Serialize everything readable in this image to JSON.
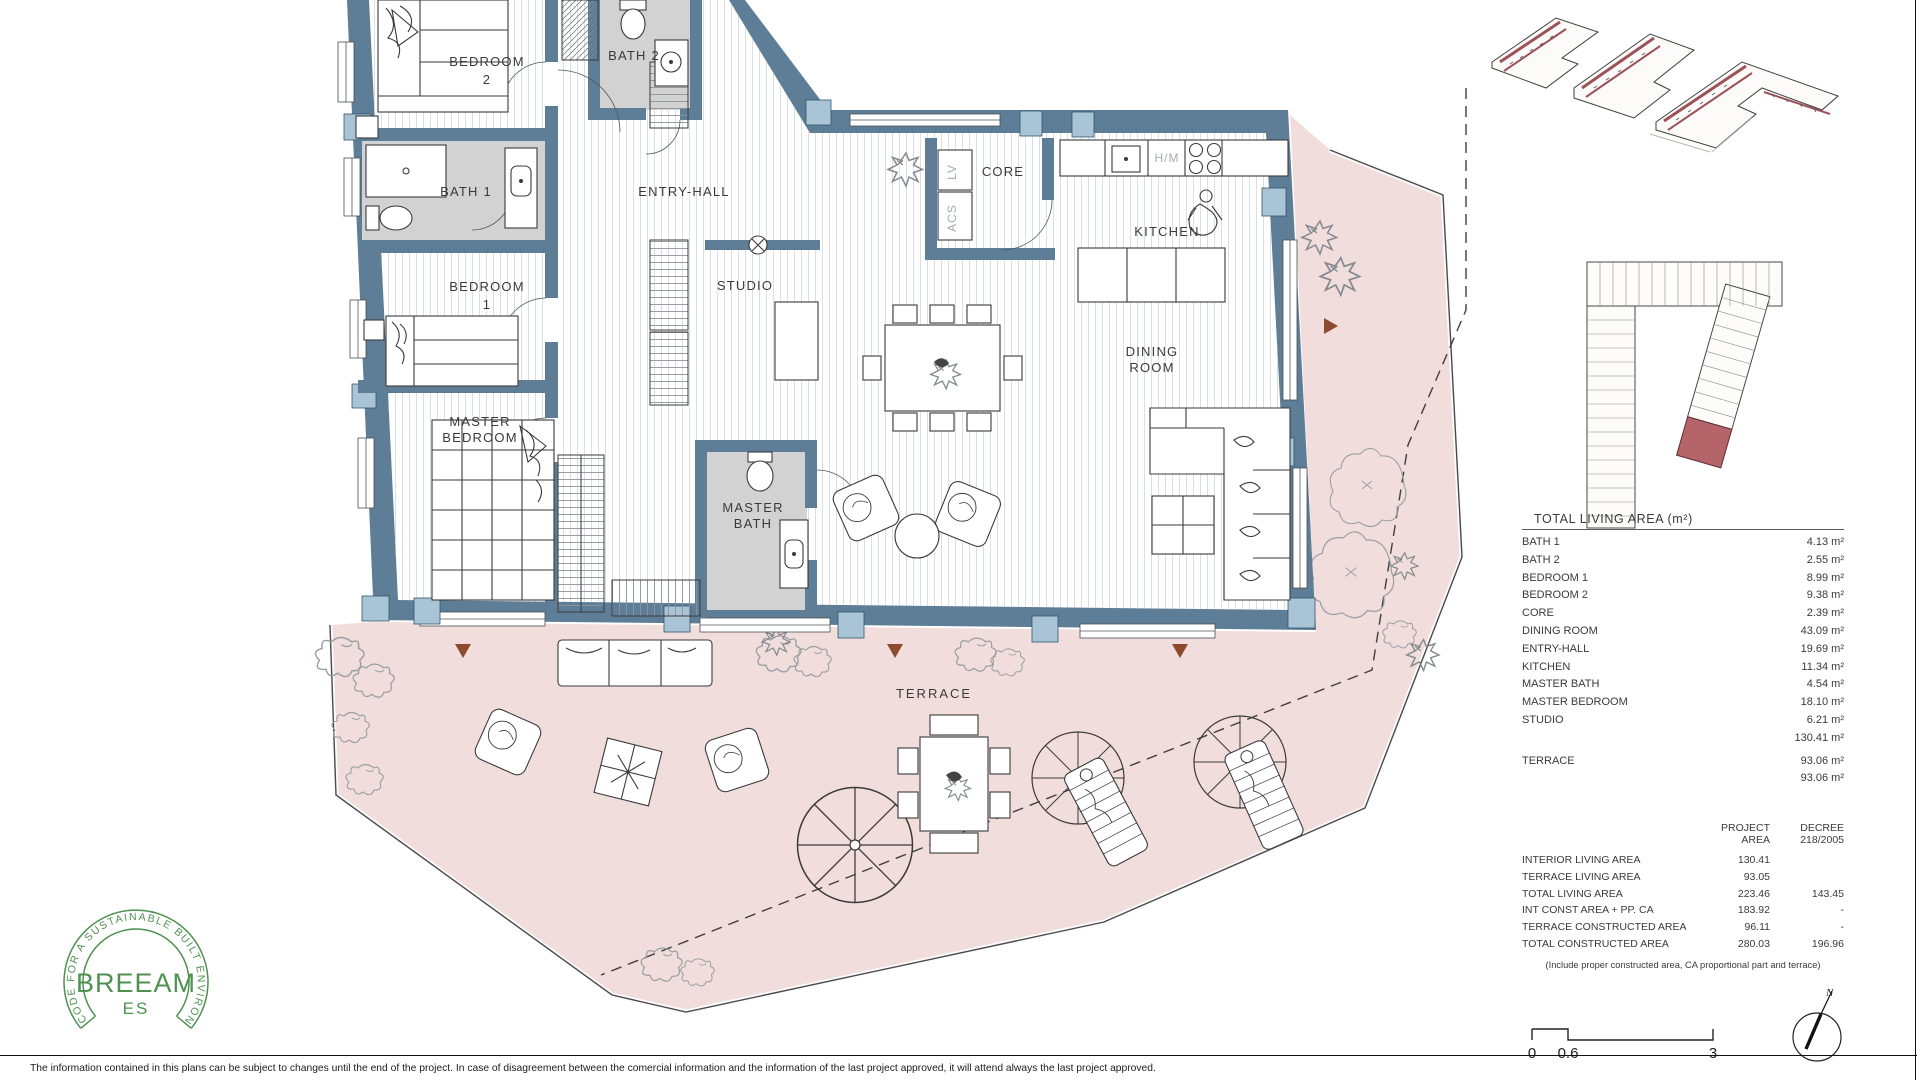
{
  "plan": {
    "rooms": {
      "bedroom2_l1": "BEDROOM",
      "bedroom2_l2": "2",
      "bath2": "BATH 2",
      "bath1": "BATH 1",
      "entry_hall": "ENTRY-HALL",
      "bedroom1_l1": "BEDROOM",
      "bedroom1_l2": "1",
      "studio": "STUDIO",
      "master_bedroom_l1": "MASTER",
      "master_bedroom_l2": "BEDROOM",
      "master_bath_l1": "MASTER",
      "master_bath_l2": "BATH",
      "core": "CORE",
      "kitchen": "KITCHEN",
      "dining_l1": "DINING",
      "dining_l2": "ROOM",
      "terrace": "TERRACE",
      "lv": "LV",
      "acs": "ACS",
      "hm": "H/M"
    },
    "colors": {
      "wall": "#5e7d96",
      "window": "#a9c4d4",
      "bath_floor": "#d2d2d2",
      "terrace": "#f1dddc",
      "marker": "#8d4a2f"
    }
  },
  "panel": {
    "background": "#f1ece8",
    "living_area_table": {
      "title": "TOTAL LIVING AREA (m²)",
      "rows": [
        {
          "label": "BATH 1",
          "value": "4.13 m²"
        },
        {
          "label": "BATH 2",
          "value": "2.55 m²"
        },
        {
          "label": "BEDROOM 1",
          "value": "8.99 m²"
        },
        {
          "label": "BEDROOM 2",
          "value": "9.38 m²"
        },
        {
          "label": "CORE",
          "value": "2.39 m²"
        },
        {
          "label": "DINING ROOM",
          "value": "43.09 m²"
        },
        {
          "label": "ENTRY-HALL",
          "value": "19.69 m²"
        },
        {
          "label": "KITCHEN",
          "value": "11.34 m²"
        },
        {
          "label": "MASTER BATH",
          "value": "4.54 m²"
        },
        {
          "label": "MASTER BEDROOM",
          "value": "18.10 m²"
        },
        {
          "label": "STUDIO",
          "value": "6.21 m²"
        },
        {
          "label": "",
          "value": "130.41 m²"
        },
        {
          "label": "TERRACE",
          "value": "93.06 m²"
        },
        {
          "label": "",
          "value": "93.06 m²"
        }
      ]
    },
    "summary_table": {
      "col1_header_l1": "PROJECT",
      "col1_header_l2": "AREA",
      "col2_header_l1": "DECREE",
      "col2_header_l2": "218/2005",
      "rows": [
        {
          "label": "INTERIOR LIVING AREA",
          "project": "130.41",
          "decree": ""
        },
        {
          "label": "TERRACE LIVING AREA",
          "project": "93.05",
          "decree": ""
        },
        {
          "label": "TOTAL LIVING AREA",
          "project": "223.46",
          "decree": "143.45"
        },
        {
          "label": "INT CONST AREA + PP. CA",
          "project": "183.92",
          "decree": "-"
        },
        {
          "label": "TERRACE CONSTRUCTED AREA",
          "project": "96.11",
          "decree": "-"
        },
        {
          "label": "TOTAL CONSTRUCTED AREA",
          "project": "280.03",
          "decree": "196.96"
        }
      ],
      "note": "(Include proper constructed area, CA proportional part and terrace)"
    },
    "site_plan": {
      "highlight_color": "#b5646a"
    }
  },
  "footer": {
    "scale": {
      "tick0": "0",
      "tick1": "0.6",
      "tick2": "3"
    },
    "compass_label": "N",
    "disclaimer": "The information contained in this plans can be subject to changes until the end of the project. In case of disagreement between the comercial information and the information of the last project approved, it will attend always the last project approved."
  },
  "logo": {
    "ring_text": "CODE FOR A SUSTAINABLE BUILT ENVIRONMENT",
    "name": "BREEAM",
    "region": "ES",
    "color": "#4f9150"
  }
}
